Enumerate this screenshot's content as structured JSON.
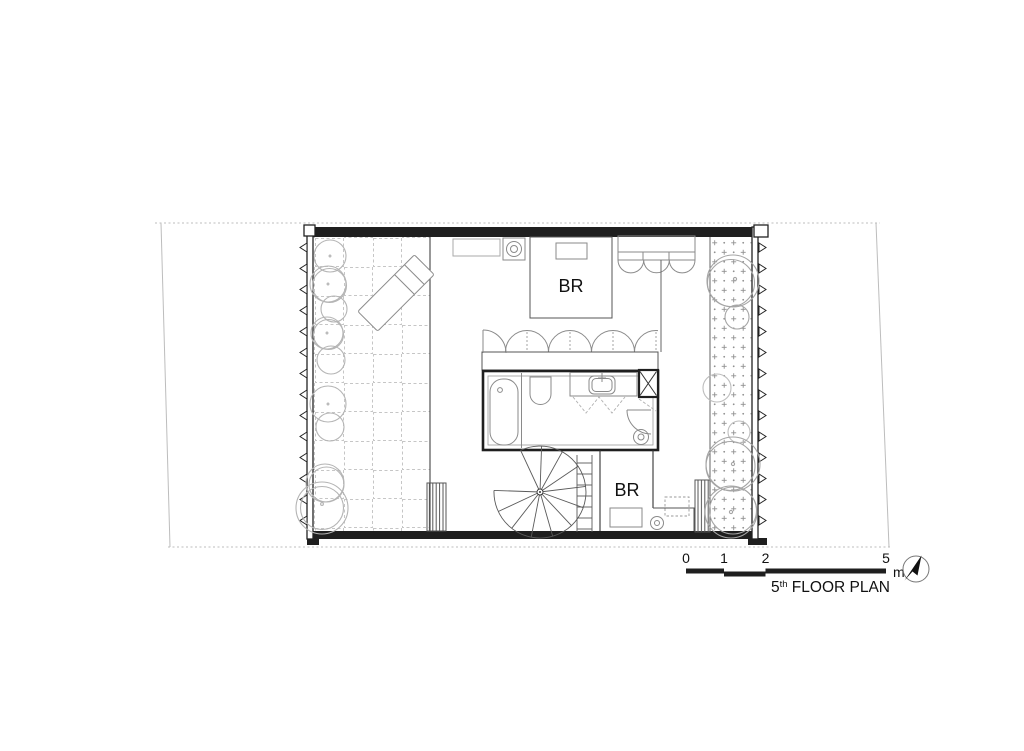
{
  "plan": {
    "labels": {
      "bedroom_upper": "BR",
      "bedroom_lower": "BR"
    },
    "title": {
      "number": "5",
      "ordinal": "th",
      "rest": " FLOOR PLAN"
    },
    "scale_bar": {
      "ticks": [
        "0",
        "1",
        "2",
        "5"
      ],
      "unit": "m"
    },
    "icons": {
      "north_arrow": "north-arrow"
    },
    "colors": {
      "wall": "#1f1f1f",
      "furniture": "#7a7a7a",
      "vegetation": "#b4b4b4",
      "site_boundary": "#bdbdbd",
      "text": "#111111"
    }
  }
}
